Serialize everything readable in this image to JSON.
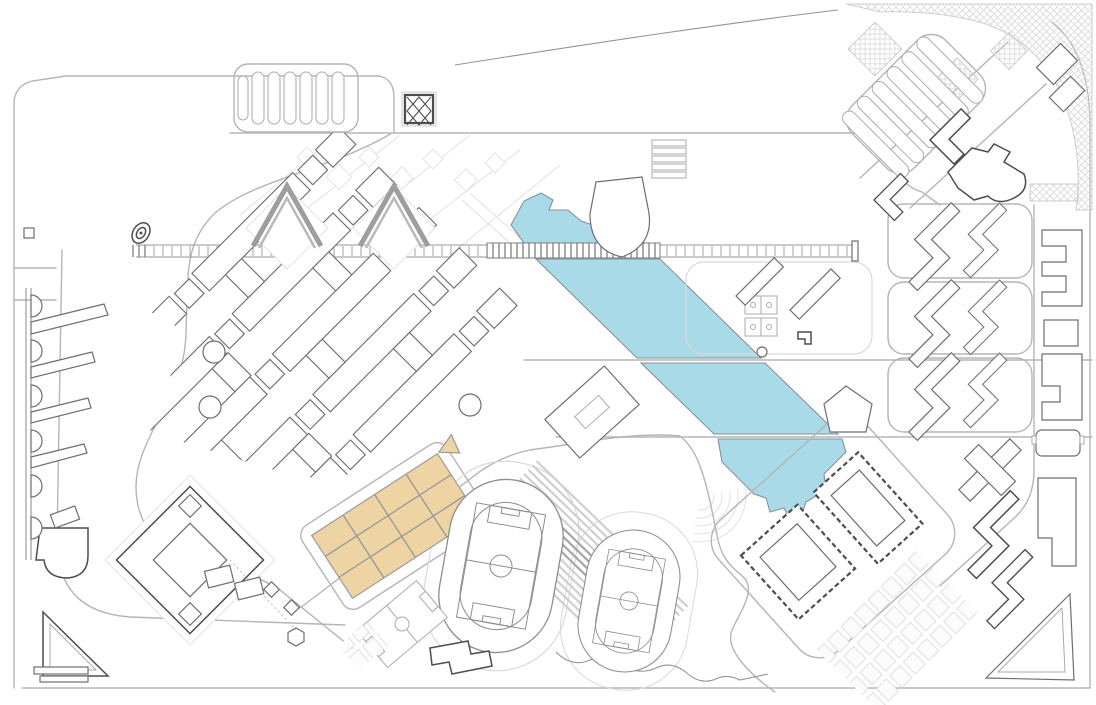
{
  "colors": {
    "paper": "#ffffff",
    "water": "#a8dbe7",
    "water_edge": "#85929a",
    "parcel": "#efd4a3",
    "parcel_edge": "#9a9a9a",
    "road": "#b5b5b5",
    "road_strong": "#949494",
    "road_faint": "#d9d9d9",
    "building": "#6e6e6e",
    "building_dark": "#4d4d4d",
    "building_light": "#ababab",
    "ghost": "#e3e3e3",
    "hatch": "#d9d9d9",
    "stand": "#cfcfcf",
    "stand_dark": "#a6a6a6",
    "tick": "#a3a3a3",
    "track": "#8d8d8d"
  },
  "features": {
    "lake": {
      "name": "lake",
      "segments": 4,
      "crossings": [
        "footbridge",
        "road",
        "road"
      ]
    },
    "pedestrian_spine": {
      "name": "east-west pedestrian spine"
    },
    "footbridge": {
      "name": "footbridge over lake"
    },
    "plaza": {
      "name": "square plaza with diagonal cross"
    },
    "north_parking": {
      "name": "north parking lot",
      "stall_rows": 6
    },
    "northeast_parking": {
      "name": "northeast parking lot",
      "aisle_rows": 6
    },
    "academic_lattice": {
      "name": "diagonal academic building grid",
      "rows": 5
    },
    "chevron_buildings": {
      "name": "chevron roof halls",
      "count": 2
    },
    "highlight_parcels": {
      "name": "highlighted development blocks",
      "columns": 4,
      "rows": 3
    },
    "running_tracks": {
      "name": "athletics tracks with soccer fields",
      "count": 2
    },
    "grandstand": {
      "name": "grandstand terraces"
    },
    "small_pitch": {
      "name": "practice soccer pitch"
    },
    "basketball_courts": {
      "name": "basketball courts",
      "count": 2
    },
    "amphitheater": {
      "name": "amphitheater terraces"
    },
    "dormitory_blocks": {
      "name": "dormitory superblocks",
      "count": 3,
      "z_buildings_per_block": 2
    },
    "east_column_buildings": {
      "name": "east edge buildings",
      "count": 5
    },
    "dashed_halls": {
      "name": "dashed outline halls",
      "count": 2
    },
    "southeast_parking_grid": {
      "name": "southeast parking grid"
    },
    "courtyard_building": {
      "name": "courtyard building"
    },
    "corner_triangle_building": {
      "name": "triangular corner building"
    },
    "piers": {
      "name": "west quay piers",
      "count": 4,
      "semicircle_slips": 6
    },
    "crosshatch_greens": {
      "name": "cross-hatched planting band"
    },
    "stream": {
      "name": "meandering stream path"
    },
    "gate_spiral": {
      "name": "spiral gate marker"
    }
  }
}
